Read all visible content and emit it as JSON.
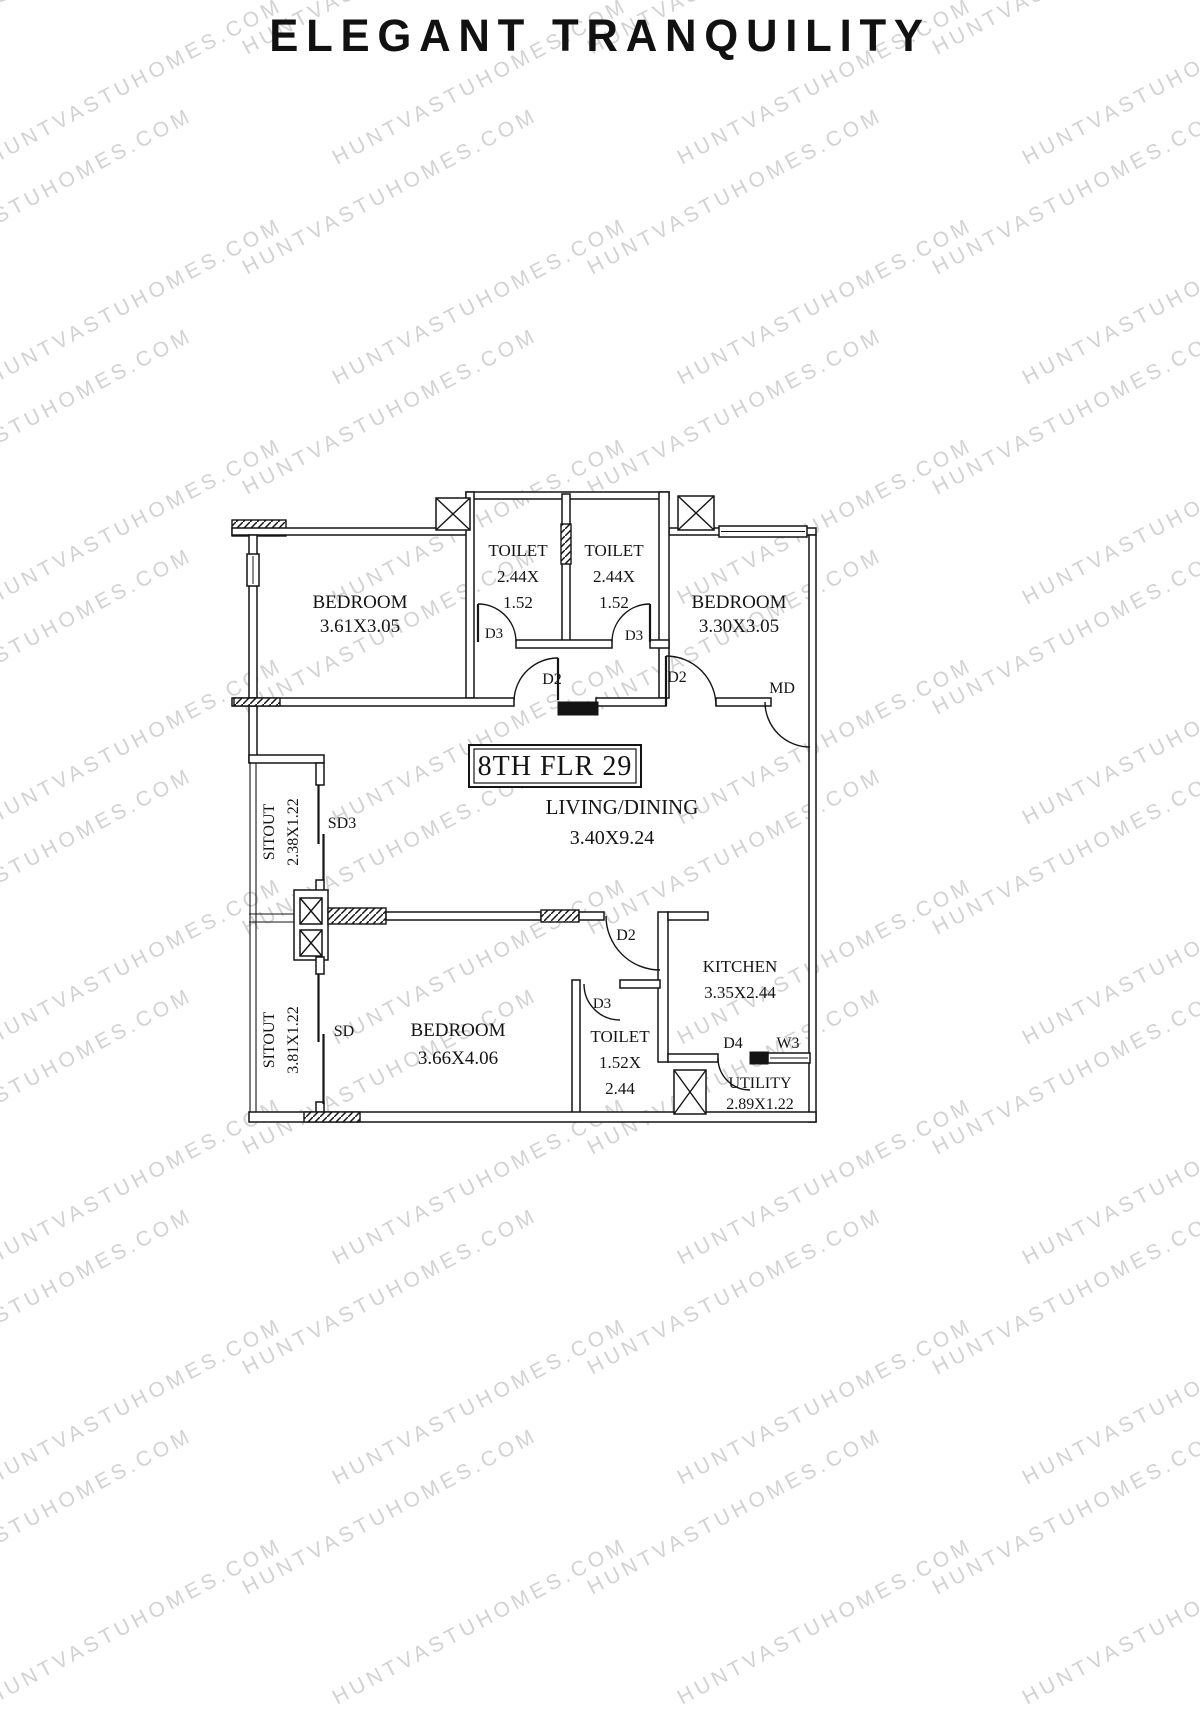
{
  "page": {
    "title": "ELEGANT TRANQUILITY",
    "watermark": "HUNTVASTUHOMES.COM"
  },
  "plan": {
    "floor_label": "8TH FLR 29",
    "rooms": {
      "bedroom_top_left": {
        "name": "BEDROOM",
        "dims": "3.61X3.05"
      },
      "bedroom_top_right": {
        "name": "BEDROOM",
        "dims": "3.30X3.05"
      },
      "bedroom_bottom": {
        "name": "BEDROOM",
        "dims": "3.66X4.06"
      },
      "toilet_top_left": {
        "name": "TOILET",
        "dims_line1": "2.44X",
        "dims_line2": "1.52"
      },
      "toilet_top_right": {
        "name": "TOILET",
        "dims_line1": "2.44X",
        "dims_line2": "1.52"
      },
      "toilet_bottom": {
        "name": "TOILET",
        "dims_line1": "1.52X",
        "dims_line2": "2.44"
      },
      "living_dining": {
        "name": "LIVING/DINING",
        "dims": "3.40X9.24"
      },
      "kitchen": {
        "name": "KITCHEN",
        "dims": "3.35X2.44"
      },
      "utility": {
        "name": "UTILITY",
        "dims": "2.89X1.22"
      },
      "sitout_upper": {
        "name": "SITOUT",
        "dims": "2.38X1.22"
      },
      "sitout_lower": {
        "name": "SITOUT",
        "dims": "3.81X1.22"
      }
    },
    "openings": {
      "d2_bedroom_top_left": "D2",
      "d2_bedroom_top_right": "D2",
      "d2_bedroom_bottom": "D2",
      "d3_toilet_top_left": "D3",
      "d3_toilet_top_right": "D3",
      "d3_toilet_bottom": "D3",
      "d4_utility": "D4",
      "main_door": "MD",
      "sliding_door_upper": "SD3",
      "sliding_door_lower": "SD",
      "window_utility": "W3"
    }
  }
}
